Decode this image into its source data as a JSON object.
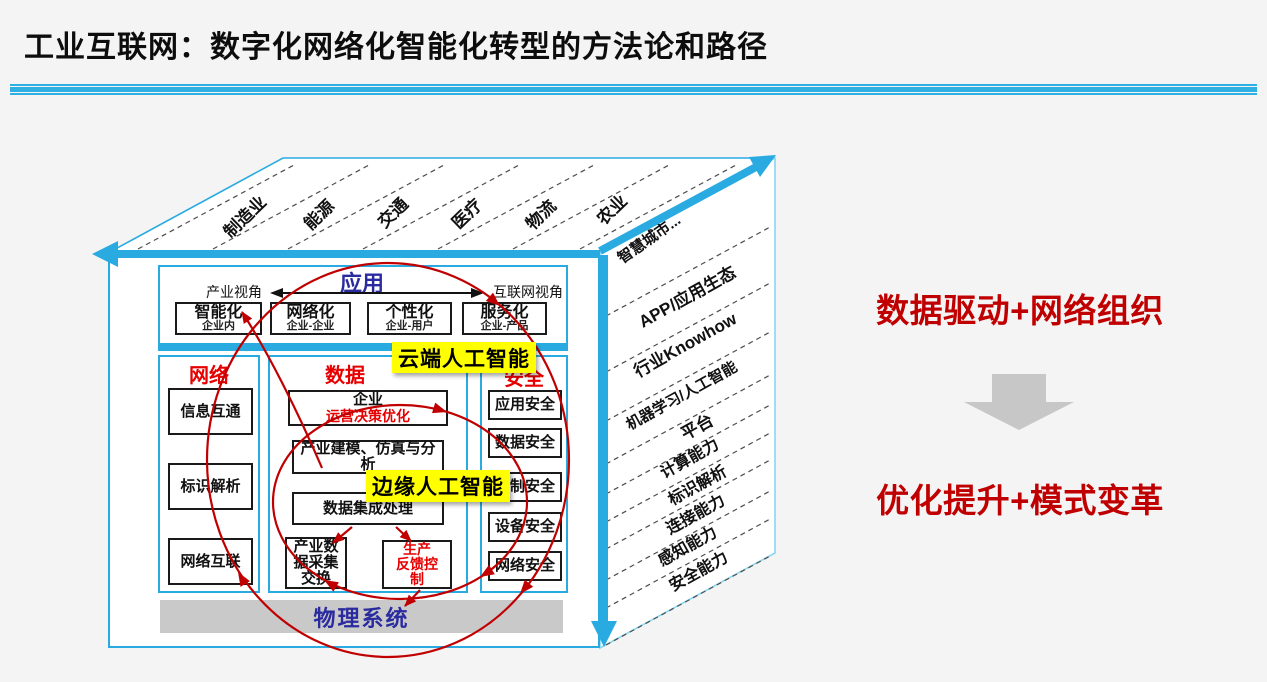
{
  "title": "工业互联网：数字化网络化智能化转型的方法论和路径",
  "colors": {
    "cube_blue": "#29ABE2",
    "red_accent": "#E60000",
    "annotation_red": "#C00000",
    "indigo": "#2B2BA0",
    "highlight_yellow": "#FFFF00",
    "gray_bar": "#C9C9C9"
  },
  "cube": {
    "top_sectors": [
      "制造业",
      "能源",
      "交通",
      "医疗",
      "物流",
      "农业",
      "智慧城市..."
    ],
    "right_layers": [
      "APP/应用生态",
      "行业Knowhow",
      "机器学习/人工智能",
      "平台",
      "计算能力",
      "标识解析",
      "连接能力",
      "感知能力",
      "安全能力"
    ],
    "application": {
      "title": "应用",
      "left_view": "产业视角",
      "right_view": "互联网视角",
      "boxes": [
        {
          "title": "智能化",
          "subtitle": "企业内"
        },
        {
          "title": "网络化",
          "subtitle": "企业-企业"
        },
        {
          "title": "个性化",
          "subtitle": "企业-用户"
        },
        {
          "title": "服务化",
          "subtitle": "企业-产品"
        }
      ]
    },
    "network": {
      "title": "网络",
      "boxes": [
        "信息互通",
        "标识解析",
        "网络互联"
      ]
    },
    "data": {
      "title": "数据",
      "box1_title": "企业",
      "box1_sub": "运营决策优化",
      "box2": "产业建模、仿真与分析",
      "box3": "数据集成处理",
      "box4": "产业数\n据采集\n交换",
      "box5": "生产\n反馈控\n制"
    },
    "security": {
      "title": "安全",
      "boxes": [
        "应用安全",
        "数据安全",
        "控制安全",
        "设备安全",
        "网络安全"
      ]
    },
    "cloud_ai": "云端人工智能",
    "edge_ai": "边缘人工智能",
    "physical": "物理系统"
  },
  "annotation": {
    "line1": "数据驱动+网络组织",
    "line2": "优化提升+模式变革"
  }
}
